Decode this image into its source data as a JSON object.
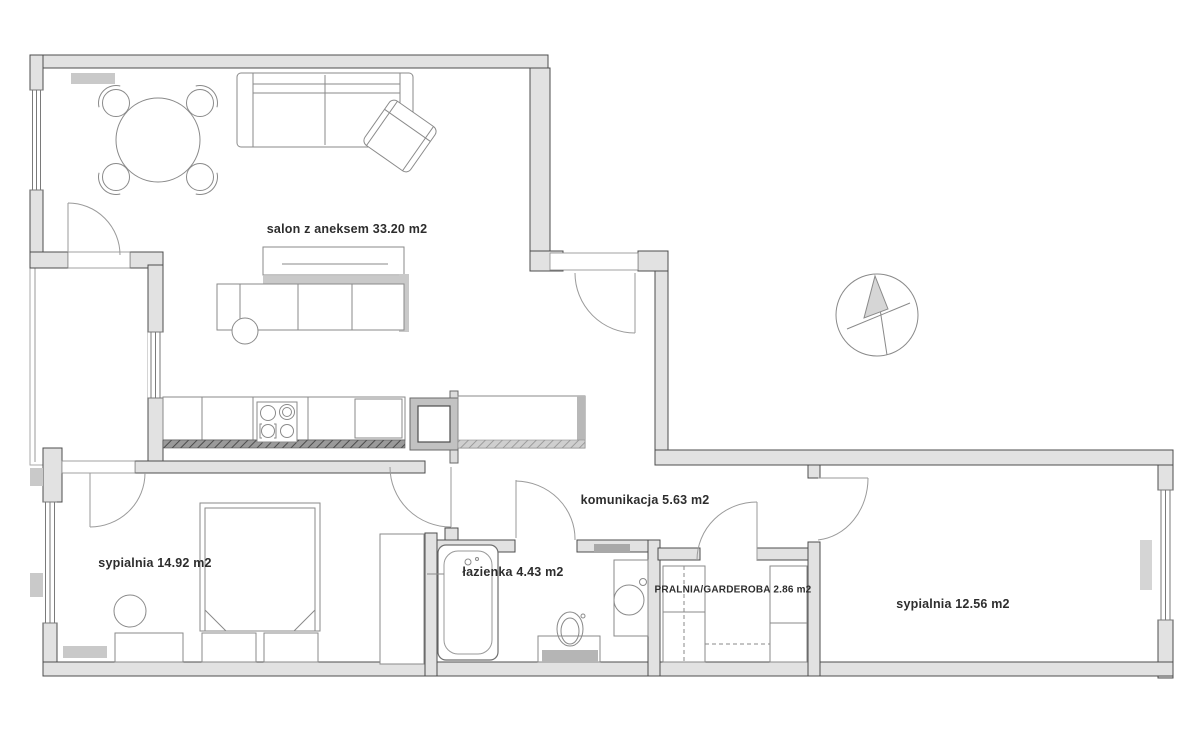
{
  "floor_plan": {
    "rooms": [
      {
        "id": "salon",
        "label": "salon z aneksem 33.20 m2",
        "name": "salon z aneksem",
        "area_m2": 33.2
      },
      {
        "id": "komunikacja",
        "label": "komunikacja 5.63 m2",
        "name": "komunikacja",
        "area_m2": 5.63
      },
      {
        "id": "sypialnia-1",
        "label": "sypialnia 14.92 m2",
        "name": "sypialnia",
        "area_m2": 14.92
      },
      {
        "id": "lazienka",
        "label": "łazienka 4.43 m2",
        "name": "łazienka",
        "area_m2": 4.43
      },
      {
        "id": "pralnia-garderoba",
        "label": "PRALNIA/GARDEROBA 2.86 m2",
        "name": "PRALNIA/GARDEROBA",
        "area_m2": 2.86
      },
      {
        "id": "sypialnia-2",
        "label": "sypialnia 12.56 m2",
        "name": "sypialnia",
        "area_m2": 12.56
      }
    ],
    "compass": {
      "icon": "north-arrow-compass-icon"
    },
    "colors": {
      "background": "#ffffff",
      "wall_fill": "#e2e2e2",
      "wall_stroke": "#4d4d4d",
      "furniture_stroke": "#8a8a8a",
      "label_color": "#2d2d2d"
    }
  }
}
